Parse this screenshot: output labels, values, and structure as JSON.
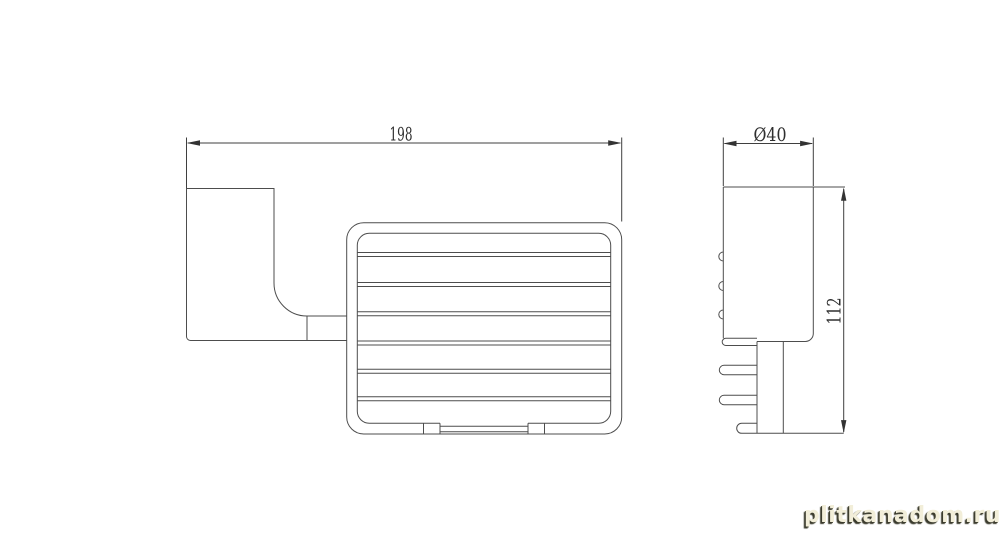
{
  "page": {
    "background_color": "#ffffff",
    "line_color": "#4d4d4d",
    "dimension_text_color": "#2f2f2f"
  },
  "drawing": {
    "type": "technical-drawing",
    "subject": "wall-mounted wire soap basket, two orthographic views",
    "front_view": {
      "width_dimension": "198",
      "features": [
        "wall-plate with curved bracket",
        "connecting arm",
        "rounded wire basket frame",
        "6 horizontal shelf wires",
        "recessed bottom center bar"
      ]
    },
    "side_view": {
      "diameter_dimension": "Ø40",
      "height_dimension": "112",
      "features": [
        "profile body",
        "3 wire bumps on left edge",
        "lower stem with 3 rounded prongs"
      ]
    }
  },
  "watermark": {
    "text": "plitkanadom.ru",
    "color": "#f2eed9",
    "shadow_color": "#3b3b2d"
  }
}
